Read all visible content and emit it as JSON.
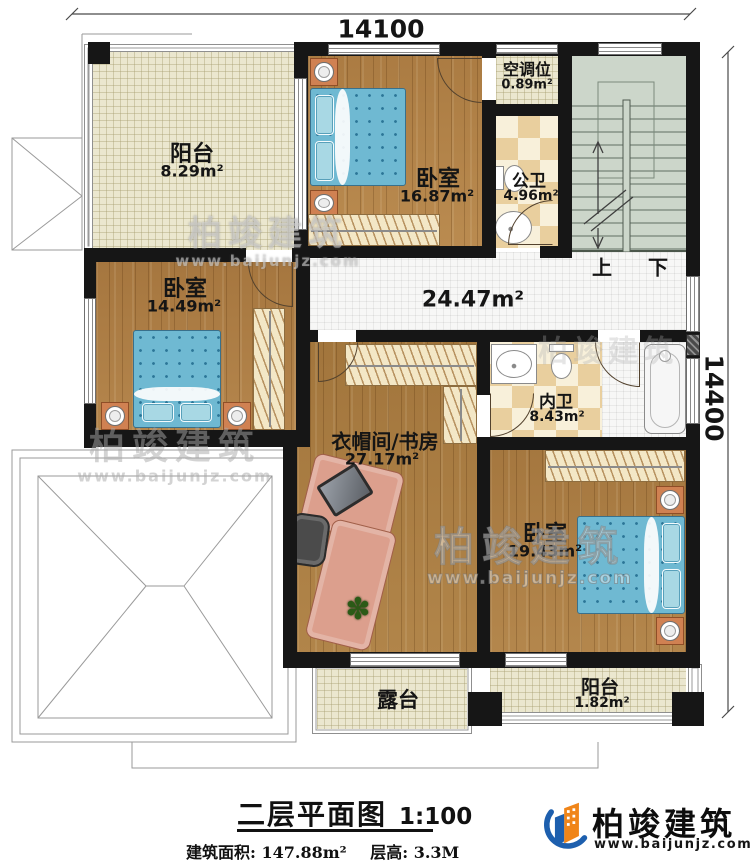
{
  "dimensions": {
    "top": "14100",
    "right": "14400"
  },
  "rooms": {
    "balcony_top": {
      "name": "阳台",
      "area": "8.29m²"
    },
    "bedroom_top": {
      "name": "卧室",
      "area": "16.87m²"
    },
    "ac_slot": {
      "name": "空调位",
      "area": "0.89m²"
    },
    "public_bath": {
      "name": "公卫",
      "area": "4.96m²"
    },
    "bedroom_left": {
      "name": "卧室",
      "area": "14.49m²"
    },
    "hallway": {
      "area": "24.47m²"
    },
    "private_bath": {
      "name": "内卫",
      "area": "8.43m²"
    },
    "study": {
      "name": "衣帽间/书房",
      "area": "27.17m²"
    },
    "bedroom_right": {
      "name": "卧室",
      "area": "19.43m²"
    },
    "terrace": {
      "name": "露台"
    },
    "balcony_bottom": {
      "name": "阳台",
      "area": "1.82m²"
    }
  },
  "stairs": {
    "up": "上",
    "down": "下"
  },
  "title_block": {
    "title": "二层平面图",
    "scale": "1:100",
    "build_area": "建筑面积: 147.88m²",
    "floor_height": "层高: 3.3M"
  },
  "brand": {
    "name": "柏竣建筑",
    "url": "www.baijunjz.com"
  },
  "watermark": {
    "name": "柏竣建筑",
    "url": "www.baijunjz.com"
  },
  "icons": {
    "plant": "✽"
  },
  "colors": {
    "wall": "#161616",
    "wood": "#ae8048",
    "tile_cream": "#ebe7cf",
    "bed_blue": "#6fb9d2",
    "bath_tile": "#e9cf9e",
    "stairs": "#ccd6ca",
    "brand_blue": "#1d5fae",
    "brand_orange": "#f08519"
  }
}
